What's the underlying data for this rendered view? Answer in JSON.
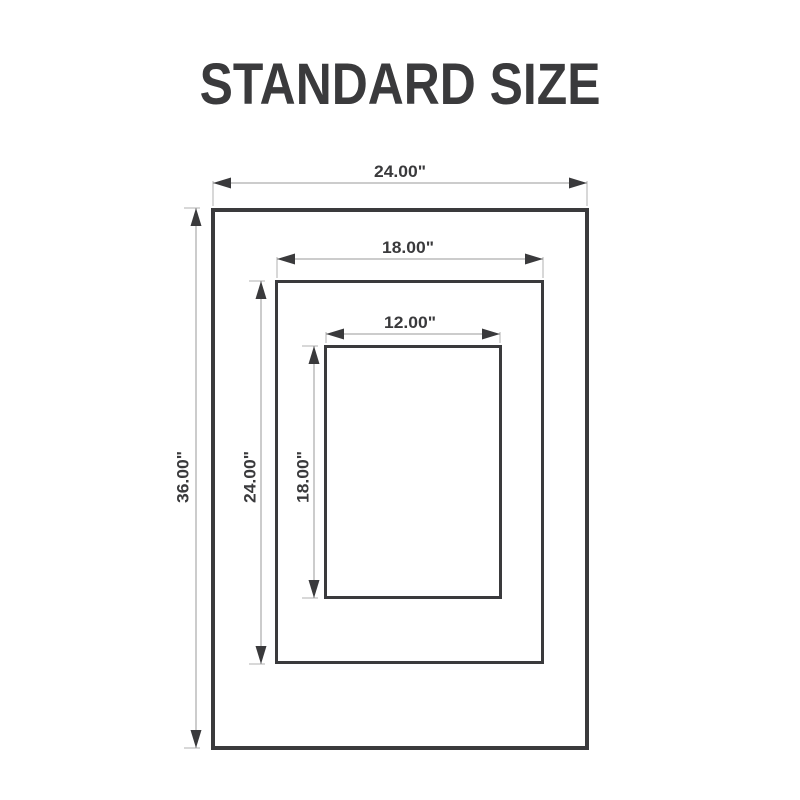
{
  "title": "STANDARD SIZE",
  "colors": {
    "ink": "#3a3a3c",
    "dim_line": "#9a9a9a",
    "background": "#ffffff"
  },
  "diagram": {
    "unit": "inches",
    "frames": [
      {
        "id": "outer",
        "width_label": "24.00\"",
        "height_label": "36.00\""
      },
      {
        "id": "middle",
        "width_label": "18.00\"",
        "height_label": "24.00\""
      },
      {
        "id": "inner",
        "width_label": "12.00\"",
        "height_label": "18.00\""
      }
    ]
  }
}
